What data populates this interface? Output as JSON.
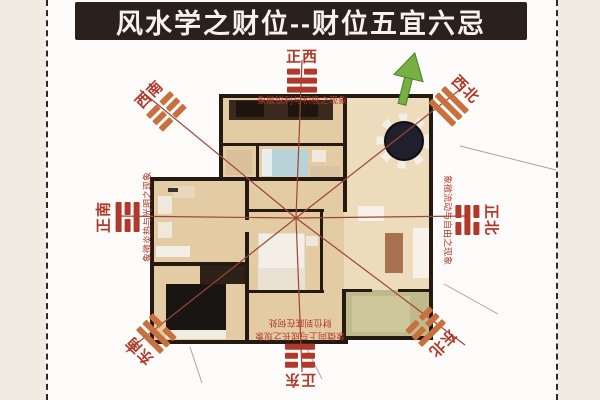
{
  "title": "风水学之财位--财位五宜六忌",
  "directions": {
    "west": {
      "label": "正西",
      "desc": "象徵锐利与积极之现象",
      "trigram": [
        "yin",
        "yang",
        "yang"
      ]
    },
    "southwest": {
      "label": "西南",
      "trigram": [
        "yin",
        "yin",
        "yin"
      ]
    },
    "northwest": {
      "label": "西北",
      "trigram": [
        "yang",
        "yang",
        "yang"
      ]
    },
    "south": {
      "label": "正南",
      "desc": "象徵炎热与光明之现象",
      "trigram": [
        "yang",
        "yin",
        "yang"
      ]
    },
    "north": {
      "label": "正北",
      "desc": "象徵流动与自由之现象",
      "trigram": [
        "yin",
        "yang",
        "yin"
      ]
    },
    "southeast": {
      "label": "东南",
      "trigram": [
        "yang",
        "yang",
        "yin"
      ]
    },
    "northeast": {
      "label": "东北",
      "trigram": [
        "yang",
        "yin",
        "yin"
      ]
    },
    "east": {
      "label": "正东",
      "desc": "象徵向上与成长之现象",
      "caption": "财位到底在何处",
      "trigram": [
        "yin",
        "yin",
        "yang"
      ]
    }
  },
  "colors": {
    "frame_bg": "#f1ebe2",
    "paper": "#fdfcfa",
    "stitch": "#2b2b2b",
    "title_bg": "#2b211c",
    "title_text": "#f7f3ec",
    "label_red": "#b0392b",
    "trigram_orange": "#c8713f",
    "line_red": "#9c4535",
    "wall_dark": "#241a12",
    "floor_tan": "#e3cba4",
    "floor_light": "#ecdcbc",
    "balcony_green": "#bfba8c",
    "bed_blue": "#b8d2da",
    "arrow_green": "#76b043",
    "table_dark": "#20202c"
  }
}
